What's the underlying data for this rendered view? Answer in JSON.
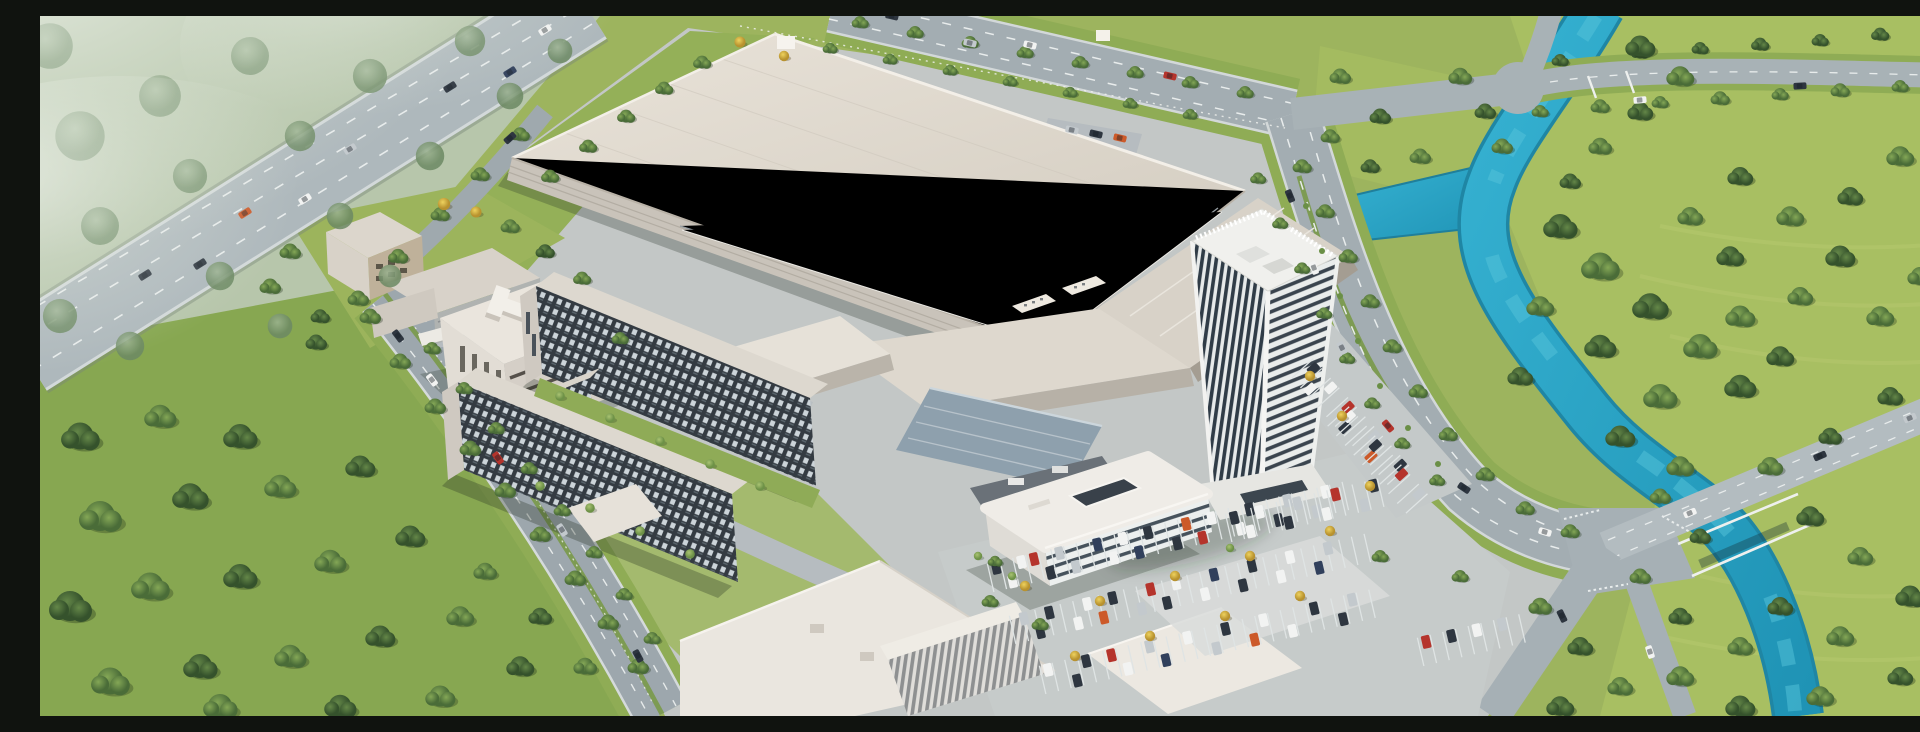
{
  "scene": {
    "title": "Aerial 3D rendering of a corporate manufacturing campus",
    "alt": "Bird's-eye architectural visualization: a huge white factory hall with flat beige roof, a white high-rise office tower, dormitory blocks with dark window-grid facades, office buildings, tree-lined boulevards, parking lots full of cars, a highway overpass in the upper left, dense forests and meadows, and a turquoise river winding along the right side with a road bridge crossing it.",
    "style": "photorealistic architectural render, daytime, soft haze in upper-left corner",
    "buildings": [
      {
        "name": "main-factory-hall",
        "roof_color": "#ddd6cb"
      },
      {
        "name": "headquarters-tower",
        "facade": "white piers with dark glass strips",
        "floors_visible": "about 25"
      },
      {
        "name": "rounded-office-building",
        "facade": "horizontal white and glass bands"
      },
      {
        "name": "dormitory-slab-1",
        "facade": "dark grid of windows"
      },
      {
        "name": "dormitory-slab-2",
        "facade": "dark grid of windows"
      },
      {
        "name": "west-office-building",
        "roof_feature": "I-shaped rooftop structure"
      },
      {
        "name": "low-annex-halls",
        "roof_color": "#d8d2c8"
      },
      {
        "name": "blue-gray-shed",
        "roof_color": "#8ea0ad"
      },
      {
        "name": "small-khaki-building",
        "roof_color": "#bfb19a"
      },
      {
        "name": "south-white-halls",
        "roof_color": "#eae6df"
      }
    ],
    "infrastructure": [
      "highway-overpass",
      "tree-lined-boulevard",
      "north-perimeter-road",
      "east-perimeter-road",
      "river-bridge-road",
      "four-way-intersection",
      "surface-parking-lots",
      "campus-fence"
    ],
    "nature": [
      "turquoise-river-with-branch",
      "dense-forest-right",
      "forest-bottom-left",
      "hazy-fields-top-left",
      "meadows",
      "yellow-autumn-trees"
    ],
    "vehicles": {
      "road_cars": "sparse traffic on all roads",
      "parked_cars": "dense rows in lots",
      "colors": [
        "#2e3640",
        "#f2f3f2",
        "#c3c9cd",
        "#b5342c",
        "#cc5a2a",
        "#31405c"
      ]
    },
    "palette": {
      "meadow": "#a6bd60",
      "forest": "#55793f",
      "haze_field": "#b7c6ab",
      "campus_ground": "#c3c7c6",
      "road": "#a3adb2",
      "river": "#2ba7c8",
      "factory_roof": "#ddd6cb",
      "tower_glass": "#303c47",
      "dorm_facade": "#343b42"
    }
  }
}
